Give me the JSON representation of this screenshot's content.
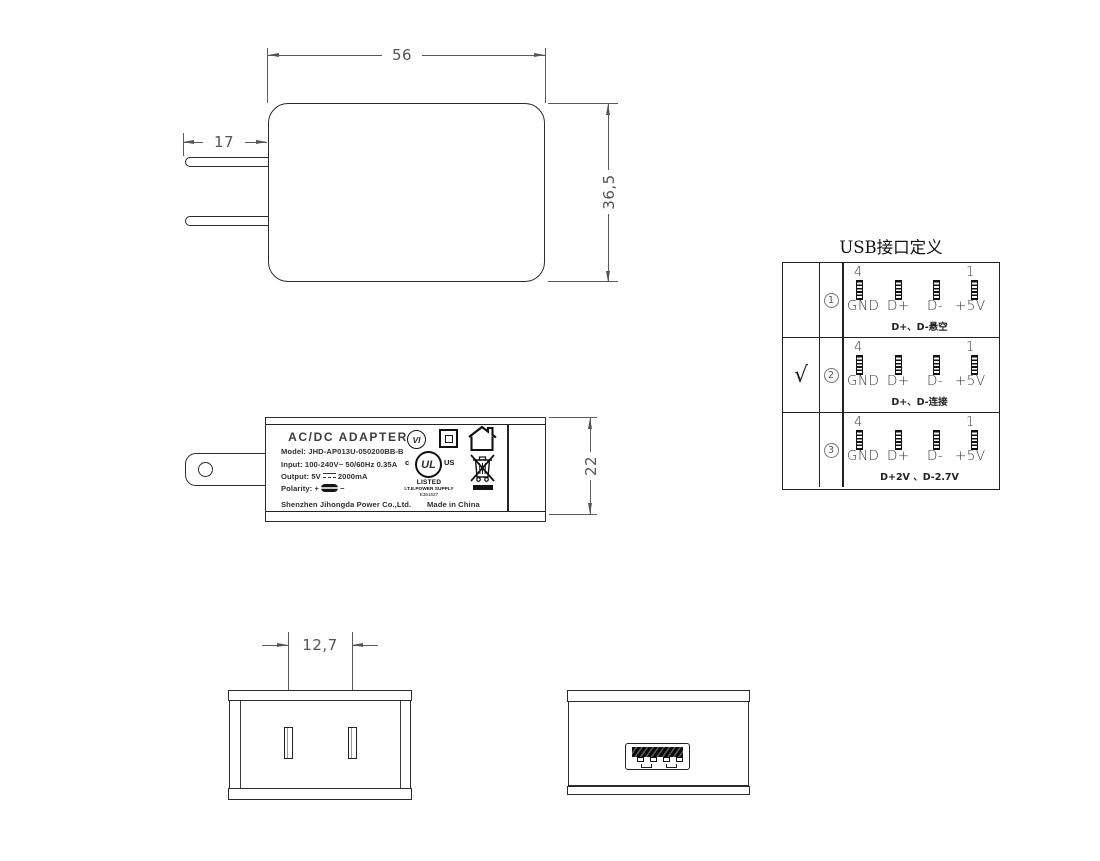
{
  "dims": {
    "front_width": "56",
    "front_height": "36,5",
    "prong_length": "17",
    "side_height": "22",
    "blade_spacing": "12,7"
  },
  "label": {
    "title": "AC/DC  ADAPTER",
    "model": "Model: JHD-AP013U-050200BB-B",
    "input": "Input: 100-240V~  50/60Hz  0.35A",
    "output_prefix": "Output: 5V",
    "output_suffix": "2000mA",
    "polarity_prefix": "Polarity:",
    "polarity_plus": "+",
    "polarity_minus": "−",
    "company": "Shenzhen Jihongda Power Co.,Ltd.",
    "made_in": "Made in China",
    "efficiency_mark": "VI",
    "ul": {
      "c": "c",
      "letters": "UL",
      "us": "US",
      "listed": "LISTED",
      "type": "I.T.E.POWER SUPPLY",
      "file": "E361627"
    }
  },
  "usb_table": {
    "title": "USB接口定义",
    "pin_number_left": "4",
    "pin_number_right": "1",
    "pin_labels": [
      "GND",
      "D+",
      "D-",
      "+5V"
    ],
    "rows": [
      {
        "check": "",
        "num": "1",
        "note": "D+、D-悬空"
      },
      {
        "check": "√",
        "num": "2",
        "note": "D+、D-连接"
      },
      {
        "check": "",
        "num": "3",
        "note": "D+2V 、D-2.7V"
      }
    ]
  },
  "colors": {
    "line": "#2b2b2b",
    "dim": "#555555",
    "background": "#ffffff"
  }
}
